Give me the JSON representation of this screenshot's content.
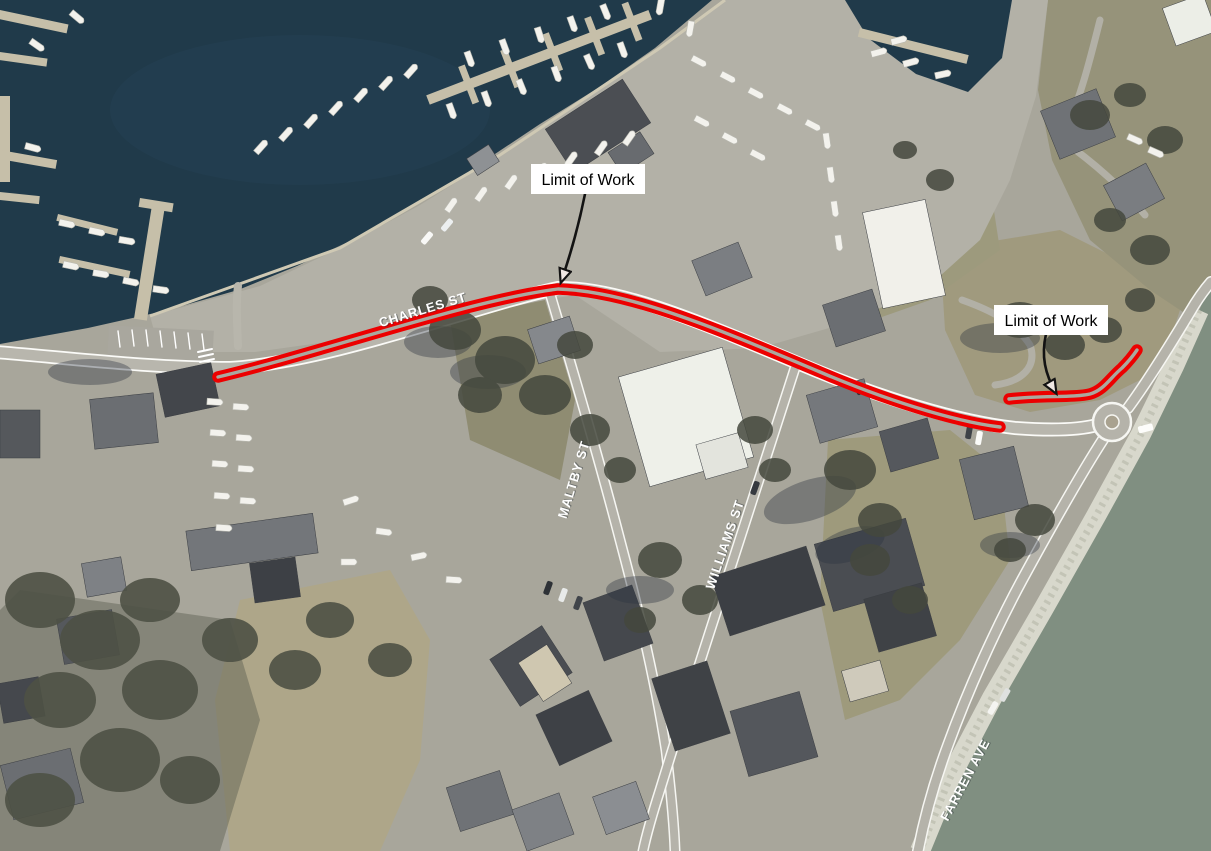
{
  "annotations": {
    "limit_of_work_west": "Limit of Work",
    "limit_of_work_east": "Limit of Work"
  },
  "streets": {
    "charles": "CHARLES ST",
    "maltby": "MALTBY ST",
    "williams": "WILLIAMS ST",
    "farren": "FARREN AVE"
  },
  "colors": {
    "work_limit_red": "#ec0000",
    "annotation_ink": "#131313",
    "label_background": "#ffffff",
    "label_text": "#000000",
    "street_label_text": "#ffffff",
    "harbor_water": "#203a4a",
    "sea_water": "#808f81",
    "riprap_shore": "#d8d8cc"
  }
}
